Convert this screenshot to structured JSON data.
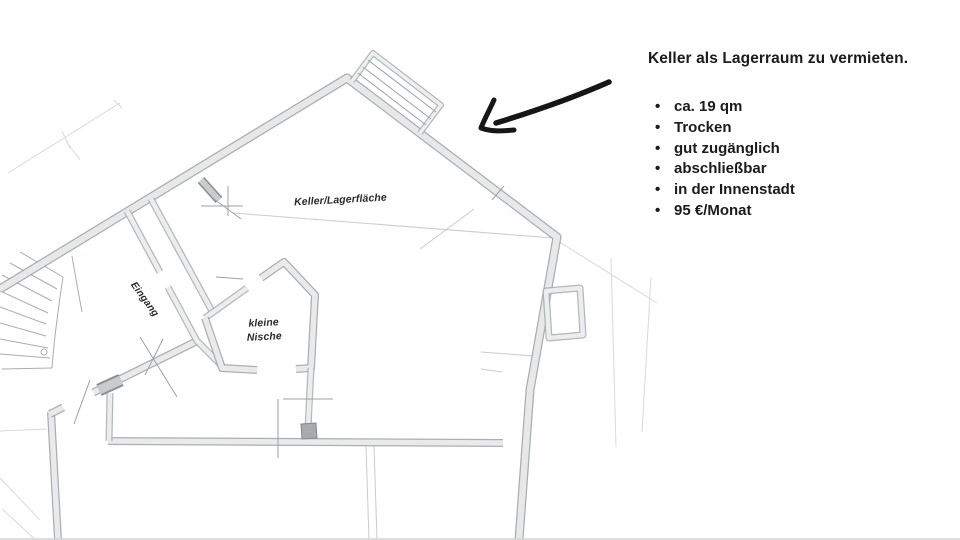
{
  "ad": {
    "title": "Keller als Lagerraum zu vermieten.",
    "bullets": [
      "ca. 19 qm",
      "Trocken",
      "gut zugänglich",
      "abschließbar",
      "in der Innenstadt",
      "95 €/Monat"
    ]
  },
  "floorplan": {
    "room_label": "Keller/Lagerfläche",
    "entrance_label": "Eingang",
    "niche_label": "kleine\nNische"
  },
  "style": {
    "ink_color": "#161616",
    "pencil_color": "#9aa0a5",
    "background": "#ffffff"
  }
}
